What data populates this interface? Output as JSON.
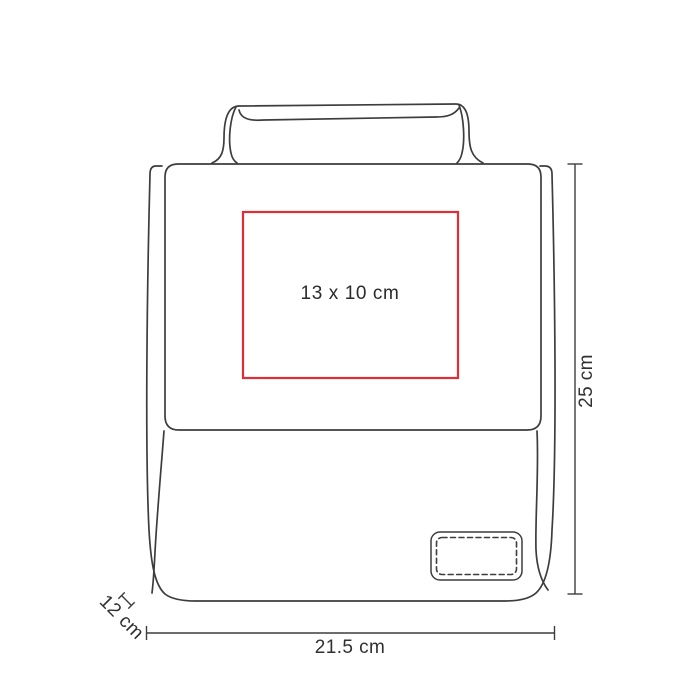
{
  "colors": {
    "background": "#ffffff",
    "line": "#3d3d3d",
    "imprint_area": "#e12d35",
    "text": "#303030"
  },
  "diagram": {
    "type": "product-dimension-line-drawing",
    "subject": "lunch bag with top handle, front flap and stitched patch",
    "labels": {
      "imprint_area": "13 x 10 cm",
      "height": "25 cm",
      "width": "21.5 cm",
      "depth": "12 cm"
    }
  }
}
